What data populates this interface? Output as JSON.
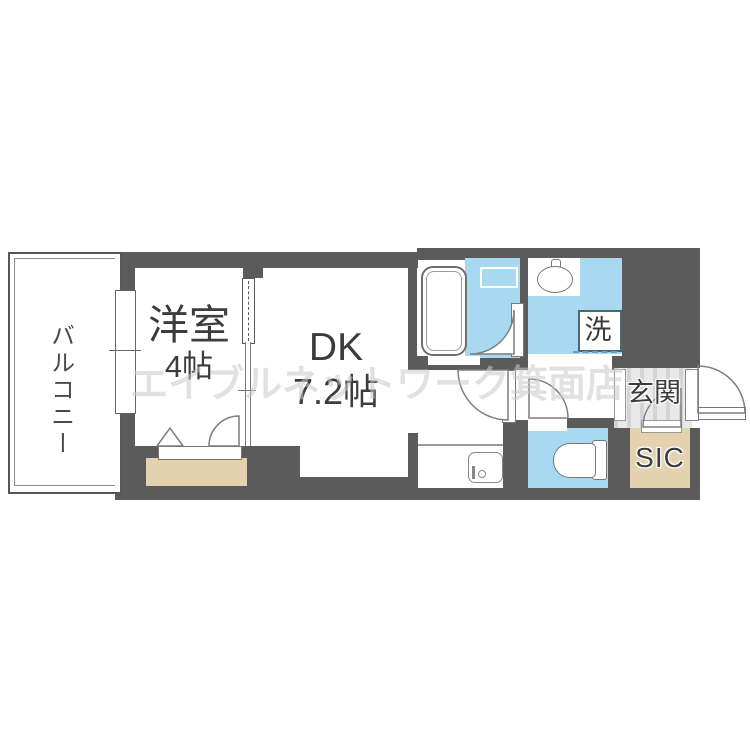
{
  "watermark_text": "エイブルネットワーク箕面店",
  "labels": {
    "balcony": "バルコニー",
    "western_room_name": "洋室",
    "western_room_size": "4帖",
    "dk_name": "DK",
    "dk_size": "7.2帖",
    "laundry": "洗",
    "entrance": "玄関",
    "shoe_closet": "SIC"
  },
  "colors": {
    "wall": "#5b5b5b",
    "water_area_blue": "#a8d9f1",
    "storage_beige": "#e4d2af",
    "entrance_floor_gray": "#e9e9e9",
    "fixture_outline": "#7d7d7d"
  }
}
